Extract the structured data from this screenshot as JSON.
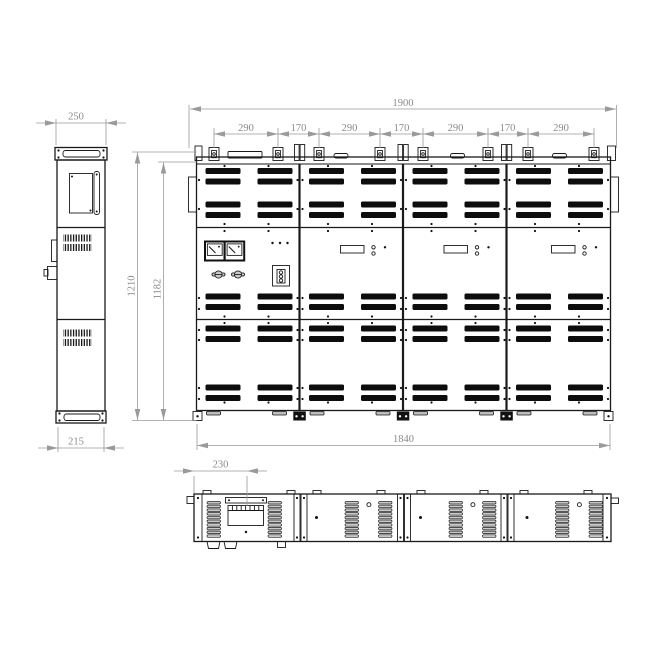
{
  "drawing_type": "cabinet-dimension-drawing",
  "colors": {
    "line": "#1a1a1a",
    "louver_fill": "#0d0d0d",
    "dimension": "#9a9a9a",
    "background": "#ffffff"
  },
  "dims": {
    "overall_width": "1900",
    "segments": [
      "290",
      "170",
      "290",
      "170",
      "290",
      "170",
      "290"
    ],
    "height_total": "1210",
    "height_body": "1182",
    "base_width": "1840",
    "side_top_width": "250",
    "side_bottom_width": "215",
    "entry_offset": "230"
  }
}
